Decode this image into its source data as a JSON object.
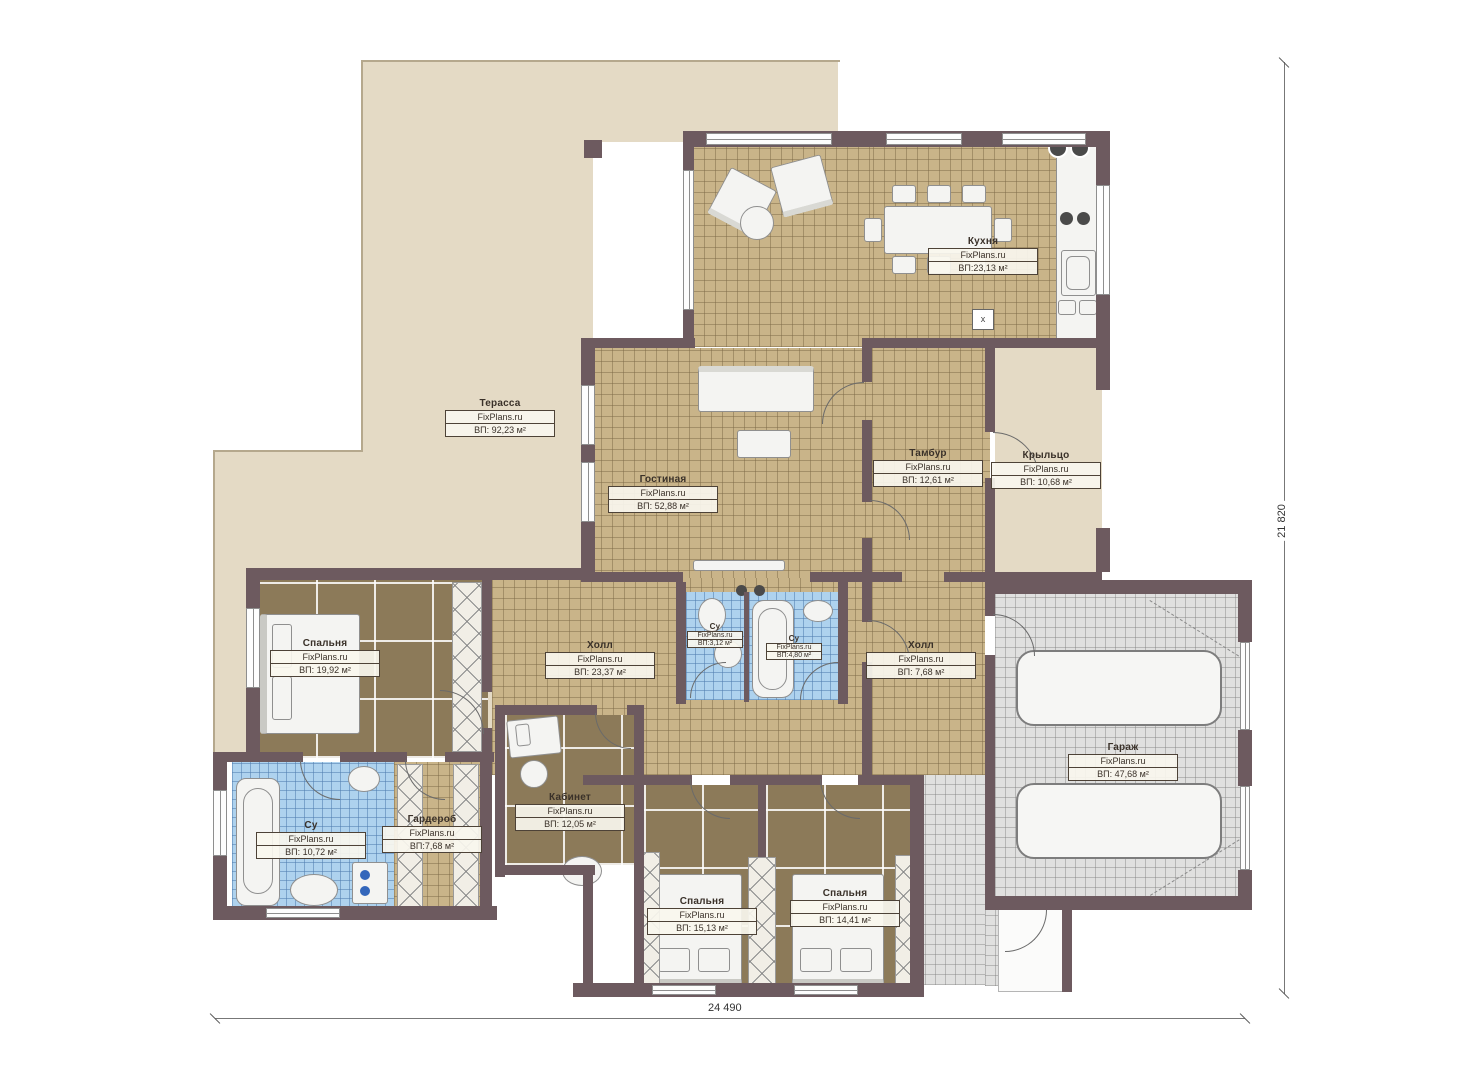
{
  "rooms": [
    {
      "id": "terrace",
      "name": "Терасса",
      "brand": "FixPlans.ru",
      "area": "ВП: 92,23 м²"
    },
    {
      "id": "kitchen",
      "name": "Кухня",
      "brand": "FixPlans.ru",
      "area": "ВП:23,13 м²"
    },
    {
      "id": "living",
      "name": "Гостиная",
      "brand": "FixPlans.ru",
      "area": "ВП: 52,88 м²"
    },
    {
      "id": "tambour",
      "name": "Тамбур",
      "brand": "FixPlans.ru",
      "area": "ВП: 12,61 м²"
    },
    {
      "id": "porch",
      "name": "Крыльцо",
      "brand": "FixPlans.ru",
      "area": "ВП: 10,68 м²"
    },
    {
      "id": "bedroom-left",
      "name": "Спальня",
      "brand": "FixPlans.ru",
      "area": "ВП: 19,92 м²"
    },
    {
      "id": "hall-main",
      "name": "Холл",
      "brand": "FixPlans.ru",
      "area": "ВП: 23,37 м²"
    },
    {
      "id": "wc-small",
      "name": "Су",
      "brand": "FixPlans.ru",
      "area": "ВП:3,12 м²"
    },
    {
      "id": "wc-mid",
      "name": "Су",
      "brand": "FixPlans.ru",
      "area": "ВП:4,80 м²"
    },
    {
      "id": "hall-right",
      "name": "Холл",
      "brand": "FixPlans.ru",
      "area": "ВП: 7,68 м²"
    },
    {
      "id": "garage",
      "name": "Гараж",
      "brand": "FixPlans.ru",
      "area": "ВП: 47,68 м²"
    },
    {
      "id": "bathroom",
      "name": "Су",
      "brand": "FixPlans.ru",
      "area": "ВП: 10,72 м²"
    },
    {
      "id": "wardrobe",
      "name": "Гардероб",
      "brand": "FixPlans.ru",
      "area": "ВП:7,68 м²"
    },
    {
      "id": "office",
      "name": "Кабинет",
      "brand": "FixPlans.ru",
      "area": "ВП: 12,05 м²"
    },
    {
      "id": "bedroom-center",
      "name": "Спальня",
      "brand": "FixPlans.ru",
      "area": "ВП: 15,13 м²"
    },
    {
      "id": "bedroom-right",
      "name": "Спальня",
      "brand": "FixPlans.ru",
      "area": "ВП: 14,41 м²"
    }
  ],
  "dimensions": {
    "width_label": "24 490",
    "height_label": "21 820"
  },
  "symbols": {
    "vent": "x"
  },
  "colors": {
    "wall": "#6d5a5f",
    "terrace": "#e4dac5",
    "tile_tan": "#c9b489",
    "carpet": "#8c7a59",
    "tile_blue": "#aed2ee",
    "tile_gray": "#e0e0df"
  }
}
